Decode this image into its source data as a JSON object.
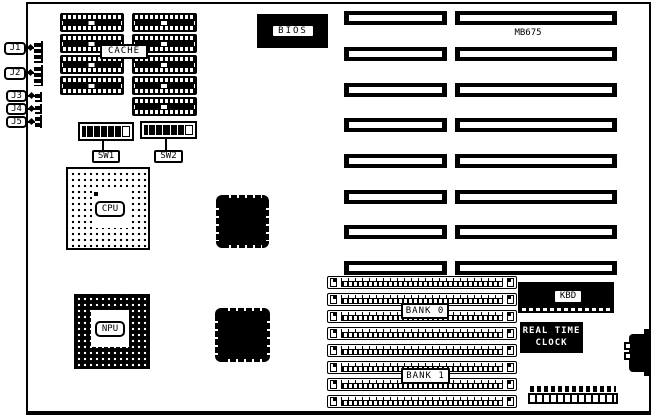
{
  "board": {
    "model": "MB675",
    "cache_label": "CACHE",
    "bios_label": "BIOS",
    "cpu_label": "CPU",
    "npu_label": "NPU",
    "kbd_label": "KBD",
    "rtc_line1": "REAL TIME",
    "rtc_line2": "CLOCK",
    "bank0_label": "BANK 0",
    "bank1_label": "BANK 1",
    "sw1_label": "SW1",
    "sw2_label": "SW2",
    "connector_labels": [
      "J1",
      "J2",
      "J3",
      "J4",
      "J5"
    ]
  },
  "colors": {
    "ink": "#000000",
    "paper": "#ffffff"
  }
}
